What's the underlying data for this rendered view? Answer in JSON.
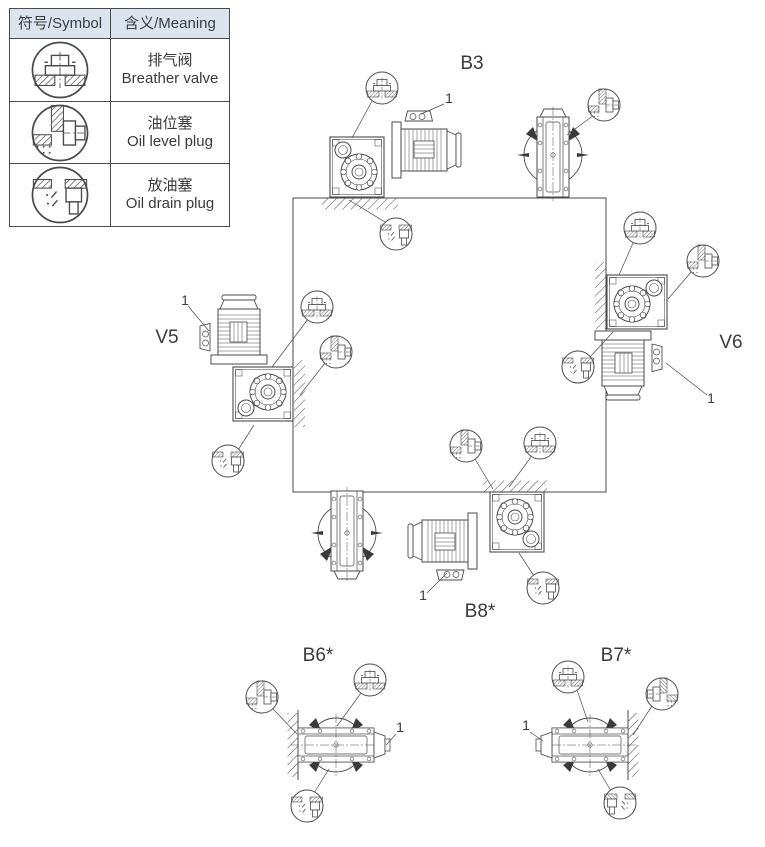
{
  "legend": {
    "header_symbol": "符号/Symbol",
    "header_meaning": "含义/Meaning",
    "rows": [
      {
        "icon": "breather-valve-symbol",
        "zh": "排气阀",
        "en": "Breather valve"
      },
      {
        "icon": "oil-level-plug-symbol",
        "zh": "油位塞",
        "en": "Oil level plug"
      },
      {
        "icon": "oil-drain-plug-symbol",
        "zh": "放油塞",
        "en": "Oil drain plug"
      }
    ]
  },
  "positions": {
    "b3": {
      "label": "B3",
      "callout": "1"
    },
    "v5": {
      "label": "V5",
      "callout": "1"
    },
    "v6": {
      "label": "V6",
      "callout": "1"
    },
    "b8": {
      "label": "B8*",
      "callout": "1"
    },
    "b6": {
      "label": "B6*",
      "callout": "1"
    },
    "b7": {
      "label": "B7*",
      "callout": "1"
    }
  },
  "colors": {
    "line": "#4a4a4a",
    "legend_header_bg": "#dbe4ee",
    "background": "#ffffff"
  }
}
